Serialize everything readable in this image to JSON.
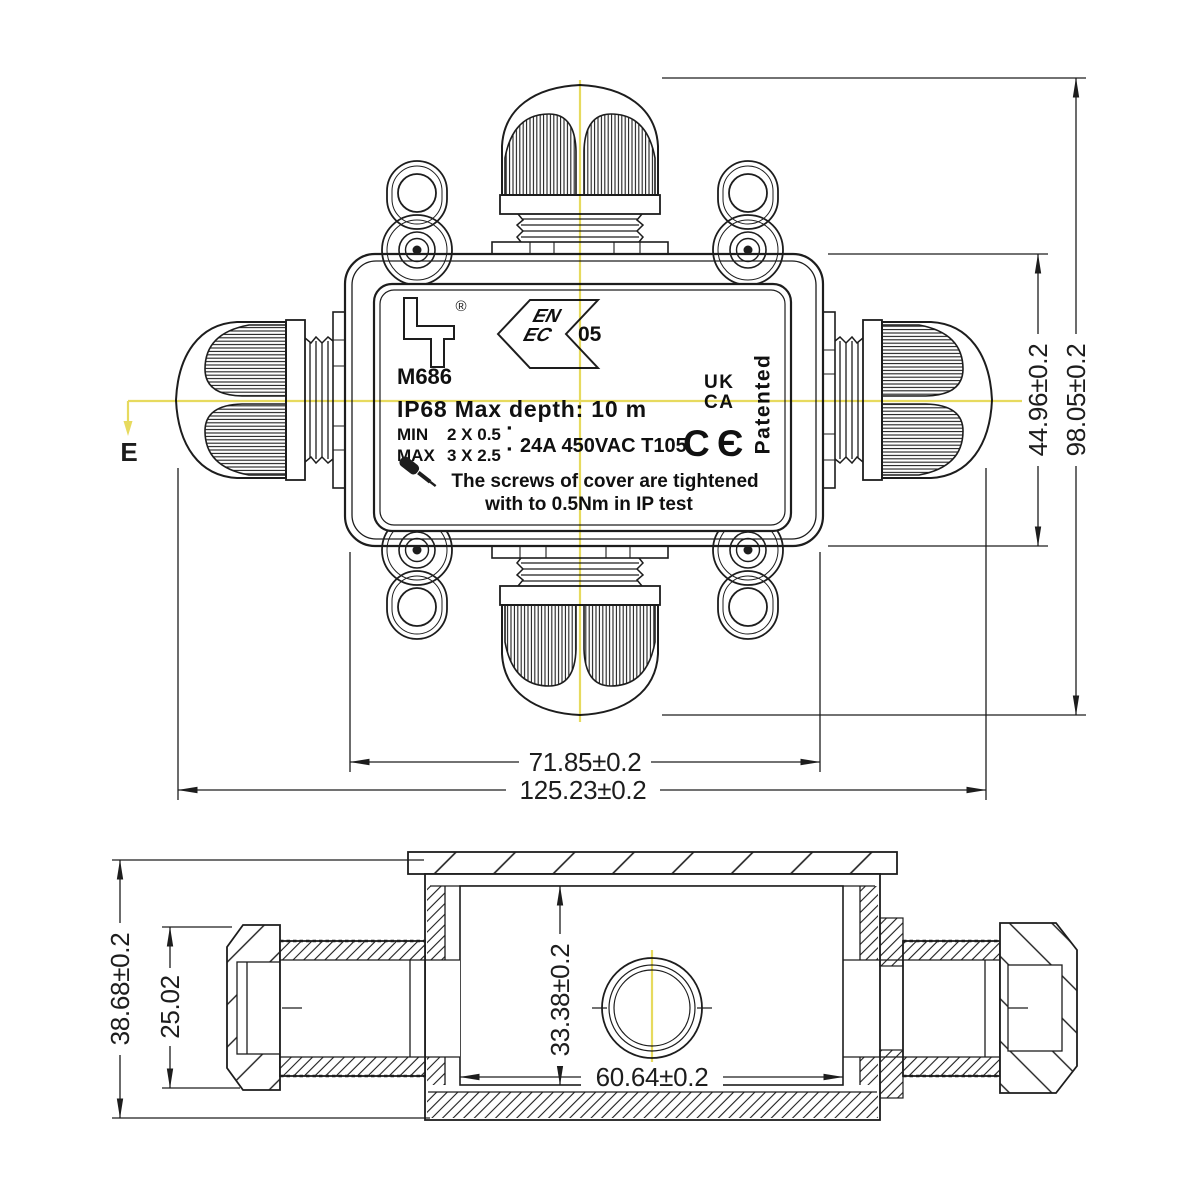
{
  "colors": {
    "background": "#ffffff",
    "line": "#1d1d1d",
    "centerline_yellow": "#e7da5e",
    "datum_magenta": "#c13fc1"
  },
  "datum": {
    "label": "E"
  },
  "top_view": {
    "dims": {
      "box_height": "44.96±0.2",
      "overall_height": "98.05±0.2",
      "box_width": "71.85±0.2",
      "overall_width": "125.23±0.2"
    },
    "label": {
      "registered": "®",
      "enec_top": "EN",
      "enec_bottom": "EC",
      "enec_number": "05",
      "model": "M686",
      "ip_rating": "IP68 Max depth: 10 m",
      "min_label": "MIN",
      "min_value": "2 X 0.5",
      "max_label": "MAX",
      "max_value": "3 X 2.5",
      "wire_square": "▪",
      "electrical": "24A 450VAC T105",
      "uk": "UK",
      "ca": "CA",
      "ce_c": "C",
      "ce_e": "Є",
      "patented": "Patented",
      "warning_line1": "The screws of cover are tightened",
      "warning_line2": "with to 0.5Nm in IP test"
    }
  },
  "side_view": {
    "dims": {
      "overall_height": "38.68±0.2",
      "gland_height": "25.02",
      "cavity_height": "33.38±0.2",
      "cavity_width": "60.64±0.2"
    }
  }
}
